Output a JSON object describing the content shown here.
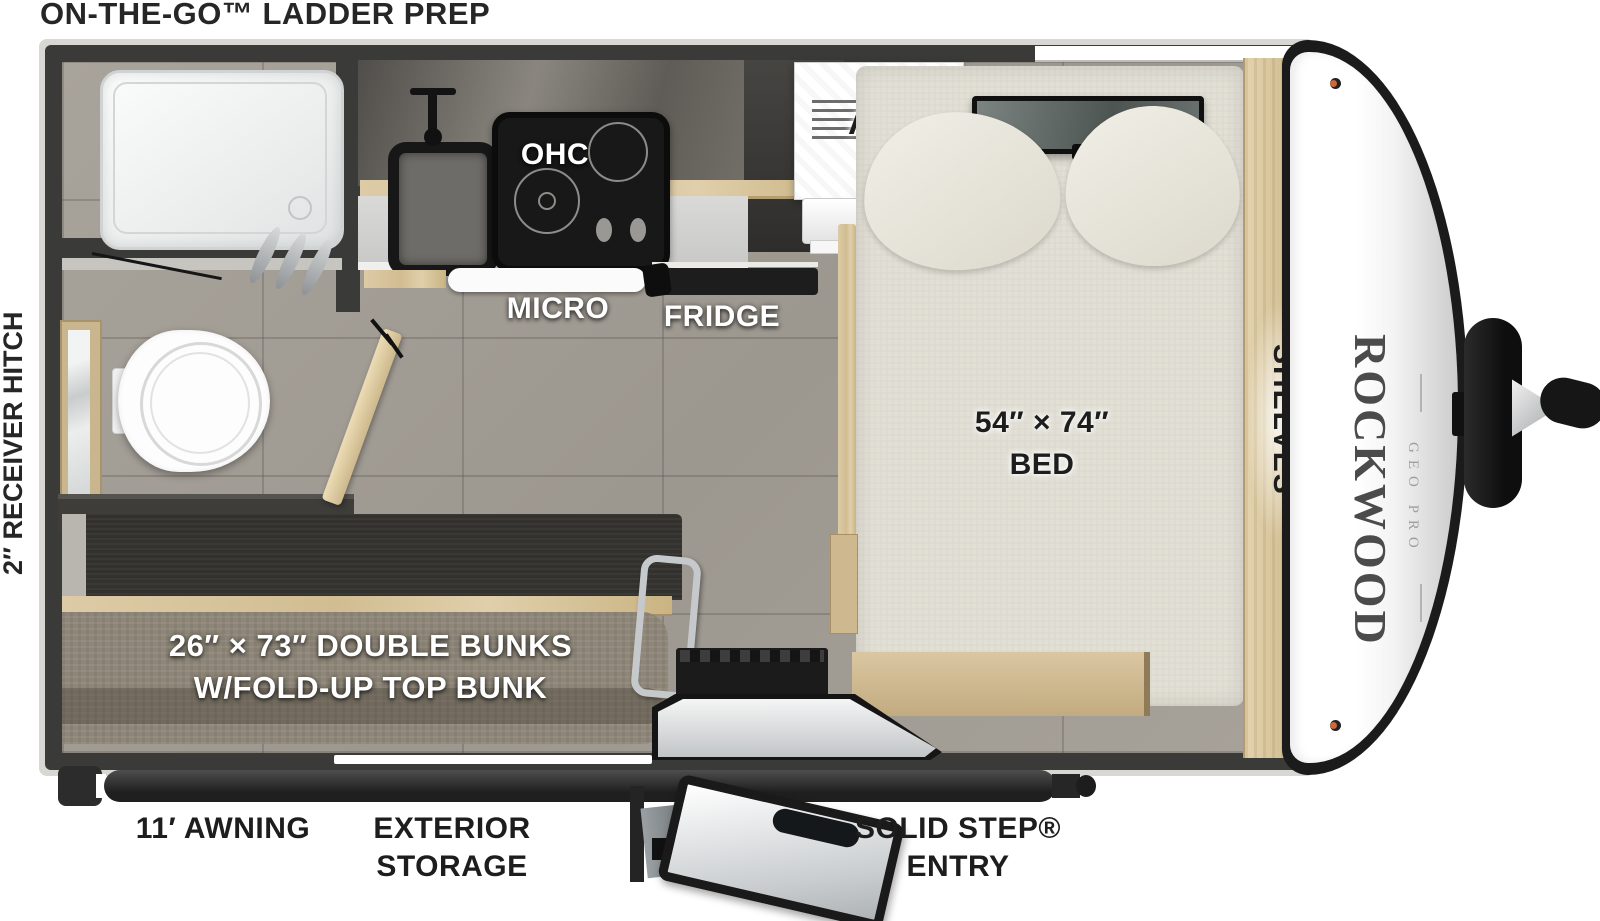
{
  "page": {
    "title": "ON-THE-GO™ LADDER PREP",
    "hitch_label": "2″ RECEIVER HITCH"
  },
  "interior": {
    "ohc": "OHC",
    "micro": "MICRO",
    "fridge": "FRIDGE",
    "ac": "A/C",
    "bed_size": "54″ × 74″",
    "bed": "BED",
    "shelves": "SHELVES",
    "bunks_line1": "26″ × 73″ DOUBLE BUNKS",
    "bunks_line2": "W/FOLD-UP TOP BUNK"
  },
  "exterior": {
    "awning": "11′ AWNING",
    "storage_line1": "EXTERIOR",
    "storage_line2": "STORAGE",
    "step_line1": "SOLID STEP®",
    "step_line2": "ENTRY"
  },
  "brand": {
    "name": "ROCKWOOD",
    "sub": "GEO PRO"
  },
  "colors": {
    "wall": "#3a3a38",
    "floor": "#a49e96",
    "wood": "#d8c6a0",
    "bunk_fabric": "#8e8678",
    "bed_fabric": "#e2dfd5",
    "label_dark": "#1d1d1d",
    "brand_text": "#4b4b4b"
  }
}
